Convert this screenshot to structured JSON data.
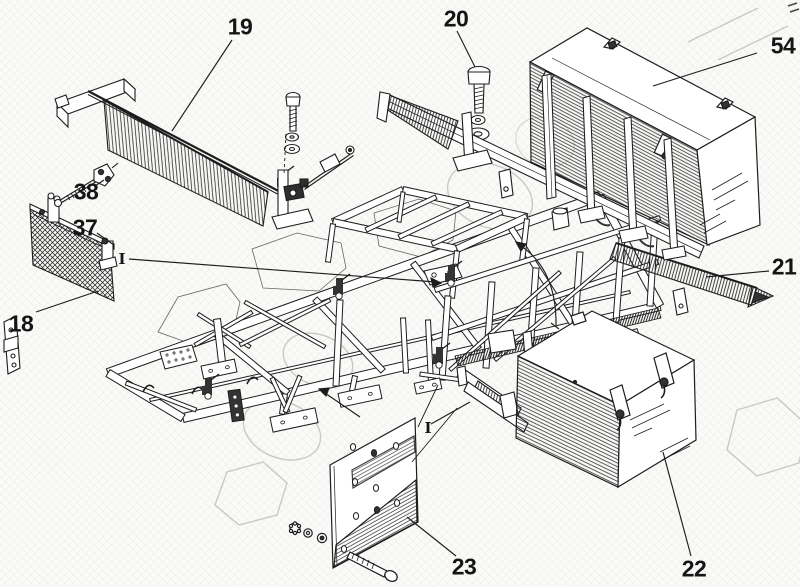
{
  "figure": {
    "kind": "exploded parts diagram",
    "subject": "chassis platform frame with tool boxes and sideboards",
    "style": {
      "paper": "#fafaf8",
      "ink": "#1d1d1d",
      "watermark": "#b9b9b4"
    }
  },
  "callouts": [
    {
      "label": "19",
      "x": 240,
      "y": 27
    },
    {
      "label": "20",
      "x": 456,
      "y": 19
    },
    {
      "label": "54",
      "x": 783,
      "y": 46
    },
    {
      "label": "38",
      "x": 86,
      "y": 192
    },
    {
      "label": "37",
      "x": 85,
      "y": 228
    },
    {
      "label": "18",
      "x": 21,
      "y": 324
    },
    {
      "label": "21",
      "x": 784,
      "y": 267
    },
    {
      "label": "23",
      "x": 464,
      "y": 567
    },
    {
      "label": "22",
      "x": 694,
      "y": 569
    }
  ],
  "view_markers": [
    {
      "label": "I",
      "x": 122,
      "y": 259
    },
    {
      "label": "I",
      "x": 428,
      "y": 428
    }
  ]
}
